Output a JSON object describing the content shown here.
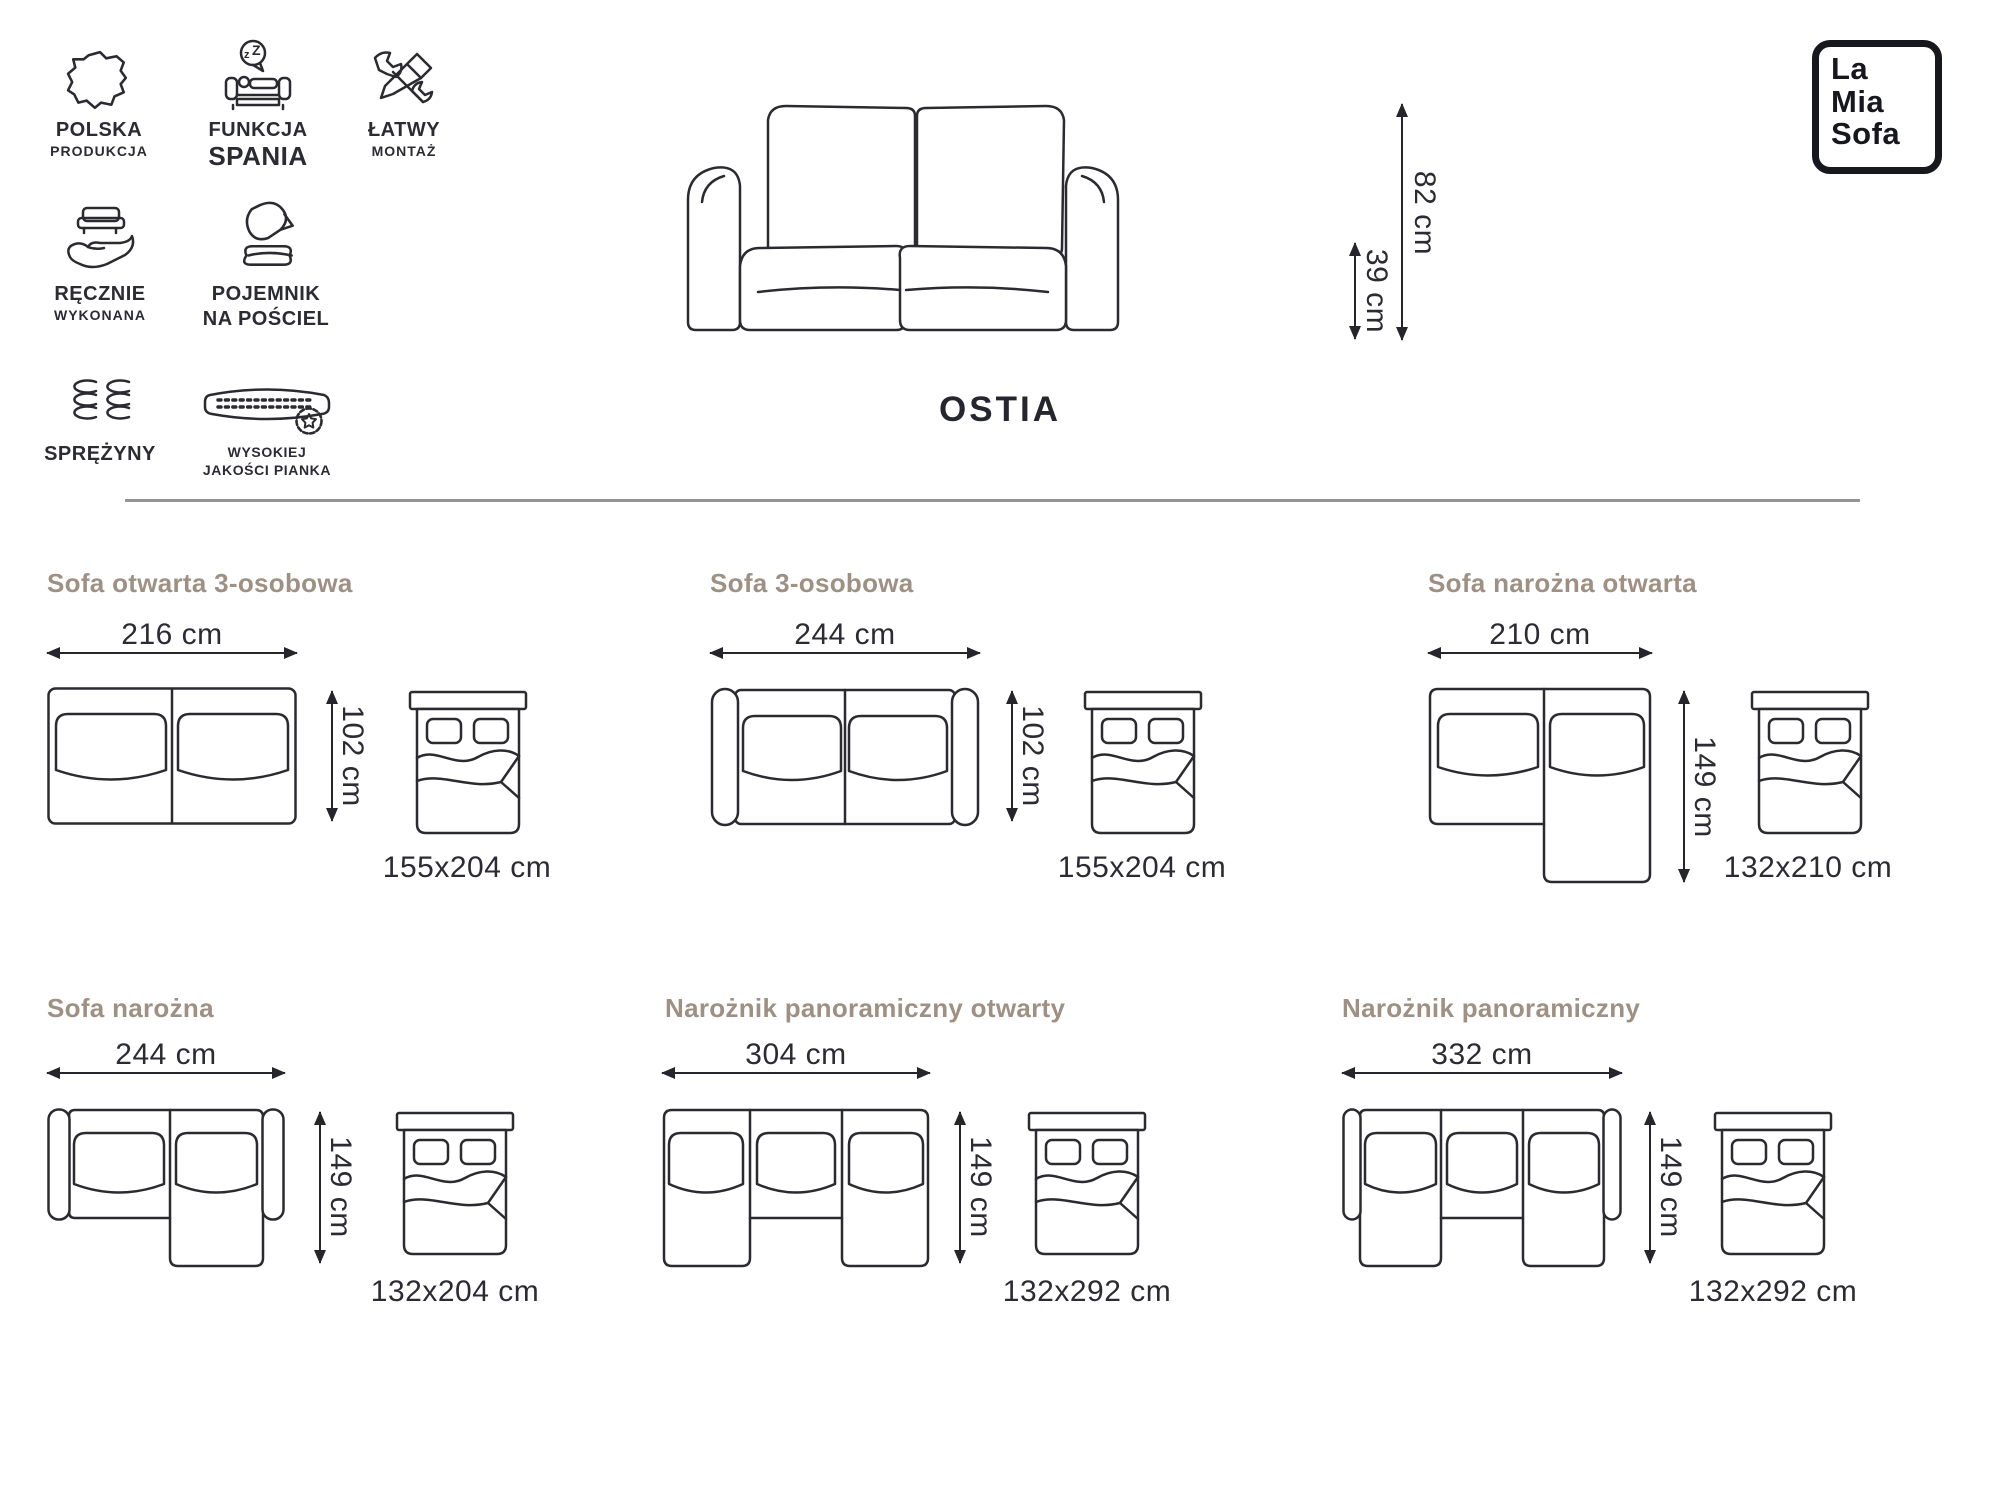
{
  "brand": {
    "logo_line1": "La",
    "logo_line2": "Mia",
    "logo_line3": "Sofa"
  },
  "product": {
    "name": "OSTIA",
    "total_height": "82 cm",
    "seat_height": "39 cm"
  },
  "features": [
    {
      "icon": "poland-map-icon",
      "line1": "POLSKA",
      "line2": "PRODUKCJA"
    },
    {
      "icon": "sleep-function-icon",
      "line1": "FUNKCJA",
      "line2": "SPANIA"
    },
    {
      "icon": "tools-icon",
      "line1": "ŁATWY",
      "line2": "MONTAŻ"
    },
    {
      "icon": "handmade-icon",
      "line1": "RĘCZNIE",
      "line2": "WYKONANA"
    },
    {
      "icon": "bedding-storage-icon",
      "line1": "POJEMNIK",
      "line2": "NA POŚCIEL"
    },
    {
      "icon": "springs-icon",
      "line1": "SPRĘŻYNY",
      "line2": ""
    },
    {
      "icon": "foam-quality-icon",
      "line1": "WYSOKIEJ",
      "line2": "JAKOŚCI PIANKA"
    }
  ],
  "configurations": [
    {
      "title": "Sofa otwarta 3-osobowa",
      "width": "216 cm",
      "depth": "102 cm",
      "mattress": "155x204 cm"
    },
    {
      "title": "Sofa 3-osobowa",
      "width": "244 cm",
      "depth": "102 cm",
      "mattress": "155x204 cm"
    },
    {
      "title": "Sofa narożna otwarta",
      "width": "210 cm",
      "depth": "149 cm",
      "mattress": "132x210 cm"
    },
    {
      "title": "Sofa narożna",
      "width": "244 cm",
      "depth": "149 cm",
      "mattress": "132x204 cm"
    },
    {
      "title": "Narożnik panoramiczny otwarty",
      "width": "304 cm",
      "depth": "149 cm",
      "mattress": "132x292 cm"
    },
    {
      "title": "Narożnik panoramiczny",
      "width": "332 cm",
      "depth": "149 cm",
      "mattress": "132x292 cm"
    }
  ]
}
